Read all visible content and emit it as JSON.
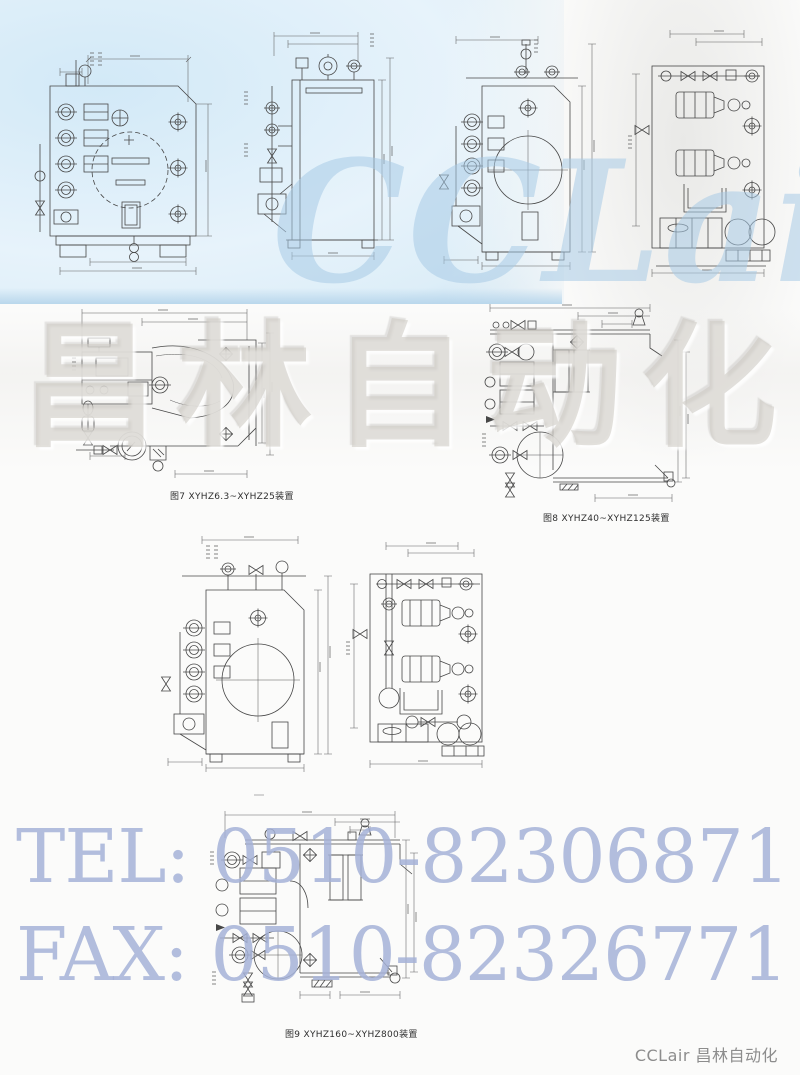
{
  "watermarks": {
    "brand": "CCLair",
    "brand_cn": "昌林自动化",
    "tel": "TEL: 0510-82306871",
    "fax": "FAX: 0510-82326771",
    "blue_text_color": "#a4b1d7",
    "brand_color": "#a8cbe6",
    "brand_cn_color": "#cecbc5"
  },
  "figures": {
    "fig7": {
      "caption": "图7 XYHZ6.3~XYHZ25装置"
    },
    "fig8": {
      "caption": "图8 XYHZ40~XYHZ125装置"
    },
    "fig9": {
      "caption": "图9 XYHZ160~XYHZ800装置"
    }
  },
  "footer": {
    "text": "CCLair 昌林自动化"
  },
  "drawing_style": {
    "line_color": "#474747",
    "dim_color": "#616161",
    "background_blue": "#d9ecf8"
  }
}
